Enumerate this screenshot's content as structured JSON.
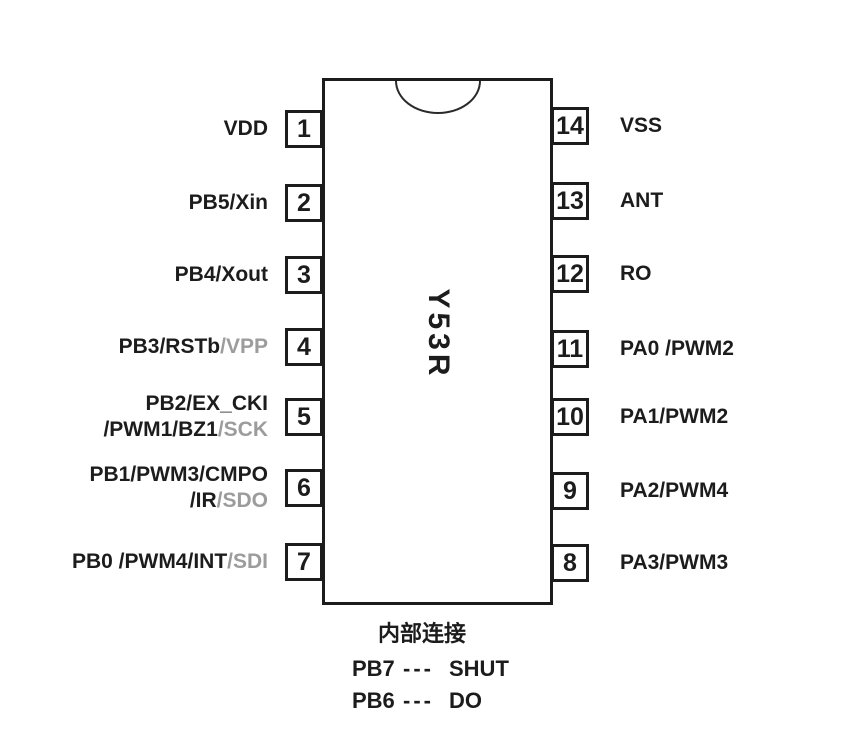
{
  "diagram": {
    "chip_name": "Y53R",
    "left_pins": [
      {
        "number": "1",
        "line1": "VDD"
      },
      {
        "number": "2",
        "line1": "PB5/Xin"
      },
      {
        "number": "3",
        "line1": "PB4/Xout"
      },
      {
        "number": "4",
        "line1": "PB3/RSTb",
        "line1_gray": "/VPP"
      },
      {
        "number": "5",
        "line1": "PB2/EX_CKI",
        "line2": "/PWM1/BZ1",
        "line2_gray": "/SCK"
      },
      {
        "number": "6",
        "line1": "PB1/PWM3/CMPO",
        "line2": "/IR",
        "line2_gray": "/SDO"
      },
      {
        "number": "7",
        "line1": "PB0 /PWM4/INT",
        "line1_gray": "/SDI"
      }
    ],
    "right_pins": [
      {
        "number": "14",
        "line1": "VSS"
      },
      {
        "number": "13",
        "line1": "ANT"
      },
      {
        "number": "12",
        "line1": "RO"
      },
      {
        "number": "11",
        "line1": "PA0 /PWM2"
      },
      {
        "number": "10",
        "line1": "PA1/PWM2"
      },
      {
        "number": "9",
        "line1": "PA2/PWM4"
      },
      {
        "number": "8",
        "line1": "PA3/PWM3"
      }
    ],
    "footer": {
      "title": "内部连接",
      "connections": [
        {
          "from": "PB7",
          "dashes": "---",
          "to": "SHUT"
        },
        {
          "from": "PB6",
          "dashes": "---",
          "to": "DO"
        }
      ]
    },
    "colors": {
      "text": "#1c1c1c",
      "muted_text": "#9c9c9c",
      "outline": "#1c1c1c",
      "background": "#ffffff"
    }
  }
}
